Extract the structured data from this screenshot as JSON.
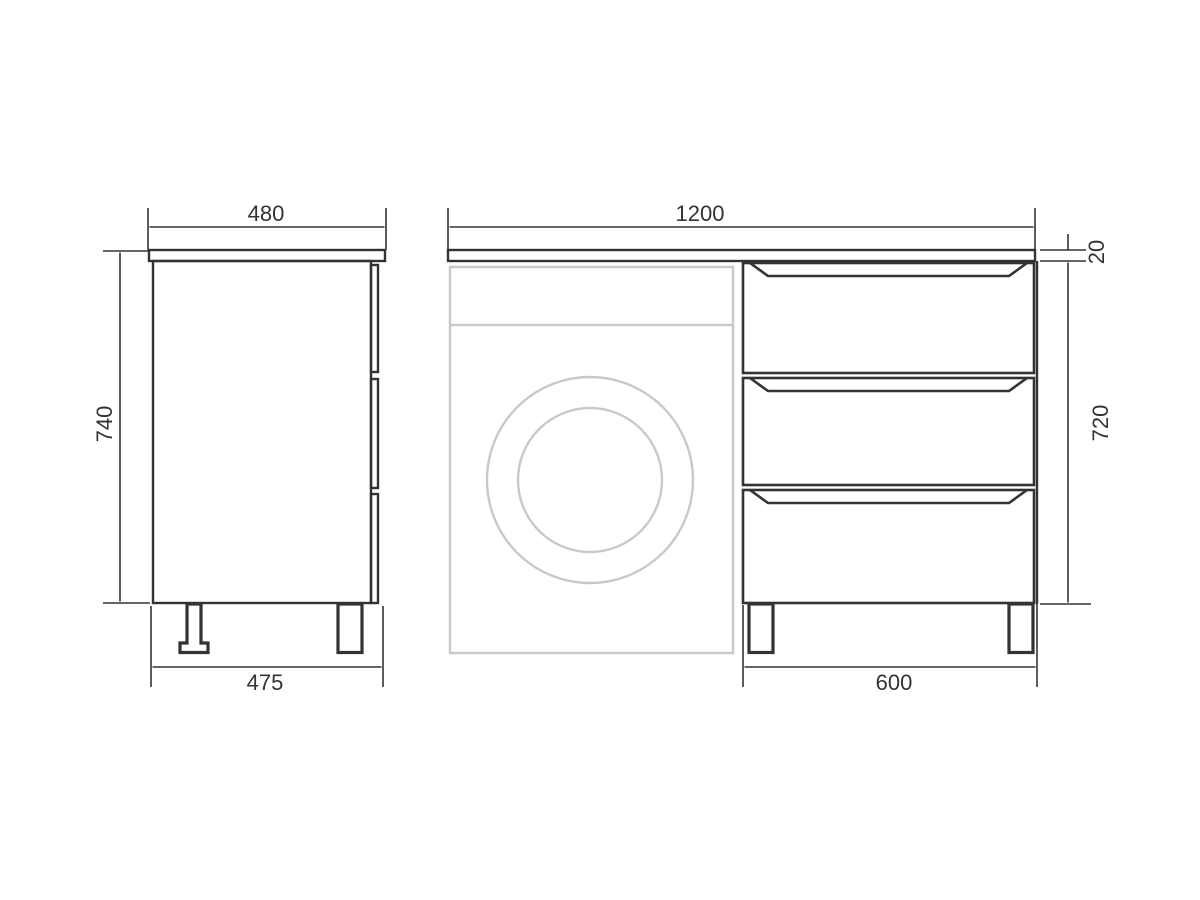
{
  "drawing": {
    "title": "Cabinet technical drawing with washing machine niche",
    "side_view": {
      "top_width_mm": "480",
      "height_mm": "740",
      "bottom_width_mm": "475"
    },
    "front_view": {
      "total_width_mm": "1200",
      "countertop_thickness_mm": "20",
      "body_height_mm": "720",
      "drawer_unit_width_mm": "600",
      "drawer_count": 3
    },
    "colors": {
      "line": "#333333",
      "washer_outline": "#c9c9c9",
      "background": "#ffffff"
    }
  }
}
